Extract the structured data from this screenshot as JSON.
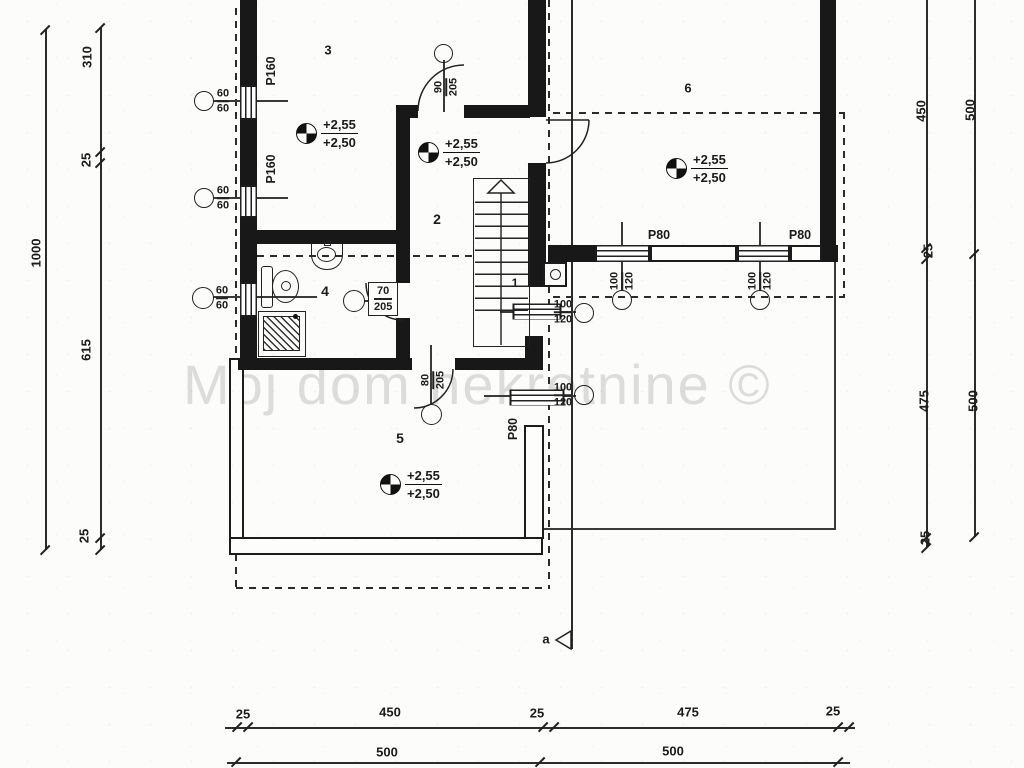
{
  "watermark": "Moj dom nekretnine ©",
  "section": {
    "label": "a"
  },
  "rooms": [
    {
      "number": "1"
    },
    {
      "number": "2"
    },
    {
      "number": "3"
    },
    {
      "number": "4"
    },
    {
      "number": "5"
    },
    {
      "number": "6"
    }
  ],
  "elevation_markers": [
    {
      "room": "3",
      "upper": "+2,55",
      "lower": "+2,50"
    },
    {
      "room": "2",
      "upper": "+2,55",
      "lower": "+2,50"
    },
    {
      "room": "6",
      "upper": "+2,55",
      "lower": "+2,50"
    },
    {
      "room": "5",
      "upper": "+2,55",
      "lower": "+2,50"
    }
  ],
  "window_labels": {
    "p160": [
      "P160",
      "P160"
    ],
    "p80_room6": [
      "P80",
      "P80"
    ],
    "p80_room5": "P80"
  },
  "window_annotations": {
    "small": [
      {
        "w": "60",
        "h": "60"
      },
      {
        "w": "60",
        "h": "60"
      },
      {
        "w": "60",
        "h": "60"
      }
    ],
    "large": [
      {
        "w": "100",
        "h": "120"
      },
      {
        "w": "100",
        "h": "120"
      },
      {
        "w": "100",
        "h": "120"
      },
      {
        "w": "100",
        "h": "120"
      }
    ]
  },
  "door_annotations": [
    {
      "w": "90",
      "h": "205"
    },
    {
      "w": "70",
      "h": "205"
    },
    {
      "w": "80",
      "h": "205"
    }
  ],
  "dimensions": {
    "left_outer": [
      "1000"
    ],
    "left_inner": [
      "310",
      "25",
      "615",
      "25"
    ],
    "right_inner": [
      "450",
      "25",
      "475",
      "25"
    ],
    "right_outer": [
      "500",
      "500"
    ],
    "bottom_upper": [
      "25",
      "450",
      "25",
      "475",
      "25"
    ],
    "bottom_lower": [
      "500",
      "500"
    ]
  }
}
